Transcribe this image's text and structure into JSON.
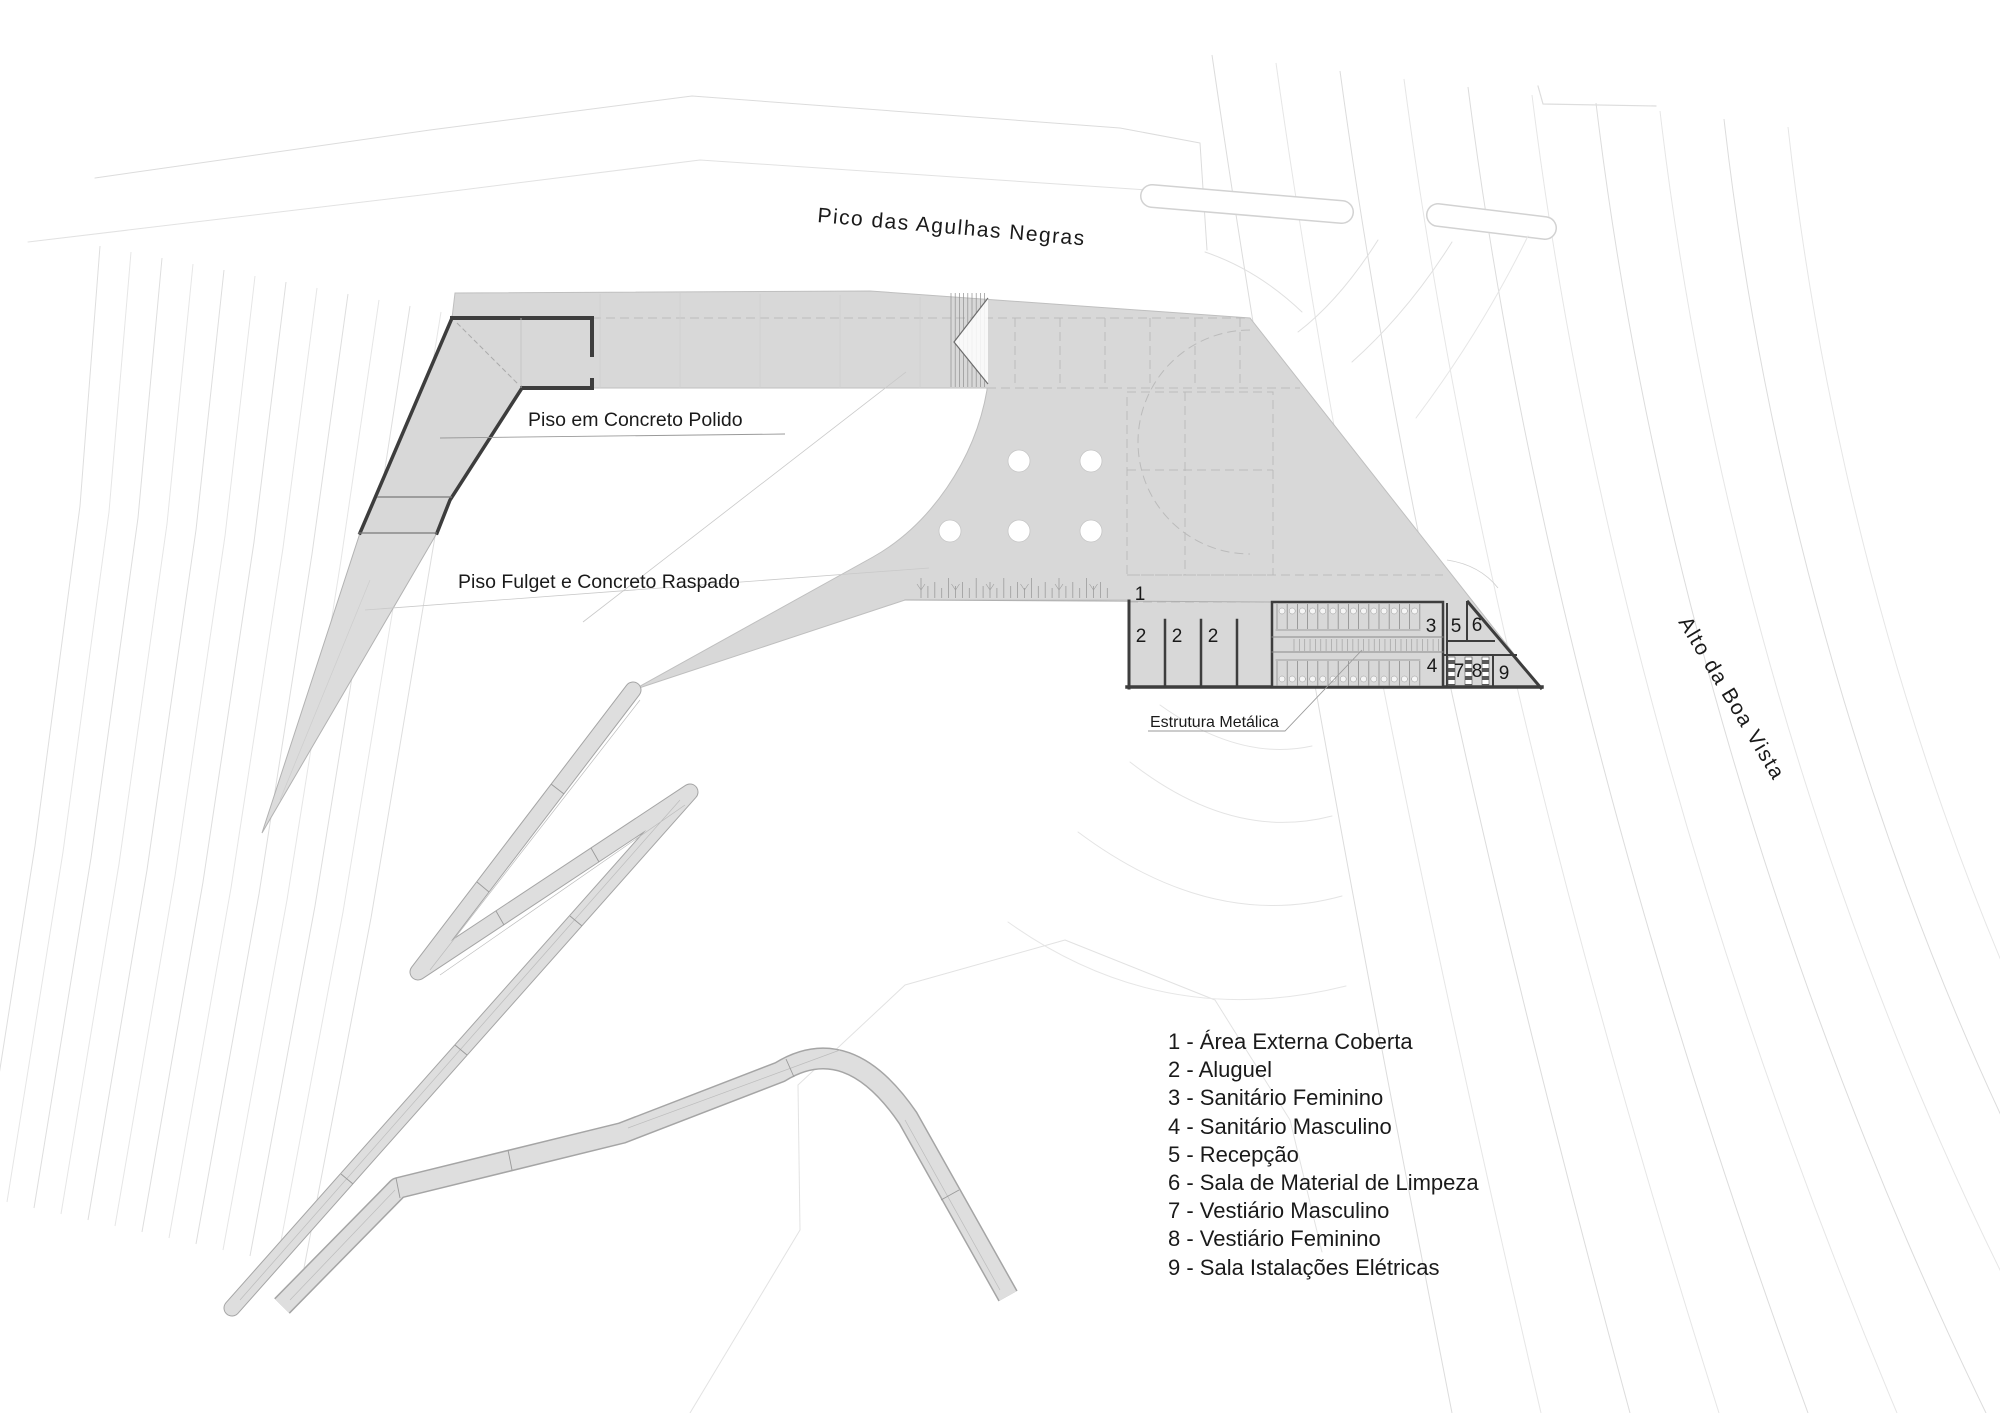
{
  "places": {
    "peak": "Pico das Agulhas Negras",
    "hill": "Alto da Boa Vista"
  },
  "annotations": {
    "polished_concrete_floor": "Piso em Concreto Polido",
    "fulget_floor": "Piso Fulget e Concreto Raspado",
    "metal_structure": "Estrutura Metálica"
  },
  "rooms": [
    {
      "num": "1",
      "name": "Área Externa Coberta"
    },
    {
      "num": "2",
      "name": "Aluguel"
    },
    {
      "num": "3",
      "name": "Sanitário Feminino"
    },
    {
      "num": "4",
      "name": "Sanitário Masculino"
    },
    {
      "num": "5",
      "name": "Recepção"
    },
    {
      "num": "6",
      "name": "Sala de Material de Limpeza"
    },
    {
      "num": "7",
      "name": "Vestiário Masculino"
    },
    {
      "num": "8",
      "name": "Vestiário Feminino"
    },
    {
      "num": "9",
      "name": "Sala Istalações Elétricas"
    }
  ],
  "legend_separator": " - ",
  "colors": {
    "paving_gray": "#d8d8d8",
    "ramp_gray": "#dedede",
    "wall_dark": "#3d3d3d",
    "contour_light": "#e4e4e4",
    "text": "#1a1a1a"
  }
}
